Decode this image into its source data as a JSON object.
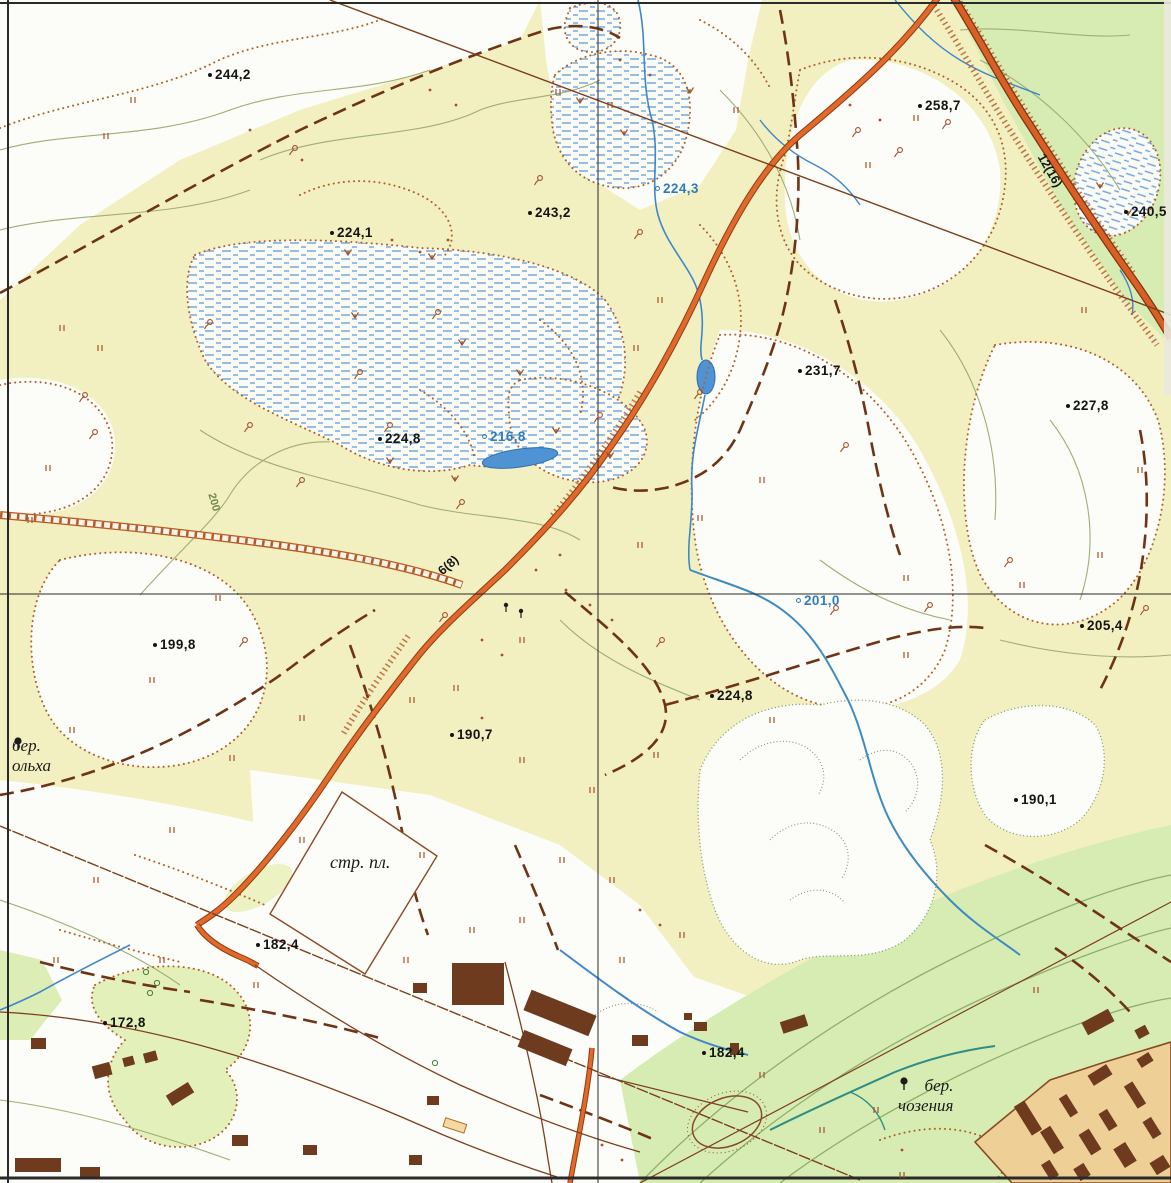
{
  "map": {
    "spot_elevations": [
      {
        "value": "244,2",
        "x": 208,
        "y": 68,
        "color": "black"
      },
      {
        "value": "224,1",
        "x": 330,
        "y": 226,
        "color": "black"
      },
      {
        "value": "243,2",
        "x": 528,
        "y": 206,
        "color": "black"
      },
      {
        "value": "224,3",
        "x": 655,
        "y": 182,
        "color": "blue"
      },
      {
        "value": "258,7",
        "x": 918,
        "y": 99,
        "color": "black"
      },
      {
        "value": "240,5",
        "x": 1124,
        "y": 205,
        "color": "black"
      },
      {
        "value": "231,7",
        "x": 798,
        "y": 364,
        "color": "black"
      },
      {
        "value": "227,8",
        "x": 1066,
        "y": 399,
        "color": "black"
      },
      {
        "value": "224,8",
        "x": 378,
        "y": 432,
        "color": "black"
      },
      {
        "value": "216,8",
        "x": 482,
        "y": 430,
        "color": "blue"
      },
      {
        "value": "201,0",
        "x": 796,
        "y": 594,
        "color": "blue"
      },
      {
        "value": "205,4",
        "x": 1080,
        "y": 619,
        "color": "black"
      },
      {
        "value": "199,8",
        "x": 153,
        "y": 638,
        "color": "black"
      },
      {
        "value": "224,8",
        "x": 710,
        "y": 689,
        "color": "black"
      },
      {
        "value": "190,7",
        "x": 450,
        "y": 728,
        "color": "black"
      },
      {
        "value": "190,1",
        "x": 1014,
        "y": 793,
        "color": "black"
      },
      {
        "value": "172,8",
        "x": 103,
        "y": 1016,
        "color": "black"
      },
      {
        "value": "182,4",
        "x": 256,
        "y": 938,
        "color": "black"
      },
      {
        "value": "182,4",
        "x": 702,
        "y": 1046,
        "color": "black"
      }
    ],
    "place_labels": {
      "construction_site": "стр. пл.",
      "alder_1": "бер.",
      "alder_2": "ольха",
      "chosenia_1": "бер.",
      "chosenia_2": "чозения",
      "contour": "200",
      "road_main": "6(8)",
      "road_ne": "12(16)"
    },
    "legend_colors": {
      "clearing_yellow": "#f2efc0",
      "open_white": "#fcfcf8",
      "meadow_green": "#d7ecb2",
      "urban_tan": "#eecf96",
      "building_brown": "#6e3b1f",
      "road_orange": "#e2692c",
      "water_blue": "#3f87c9",
      "marsh_blue": "#6fa3d8",
      "track_brown": "#6f3316",
      "contour_olive": "#9fae76"
    },
    "decorations": {
      "grass": [
        [
          133,
          100
        ],
        [
          106,
          136
        ],
        [
          62,
          328
        ],
        [
          48,
          468
        ],
        [
          100,
          348
        ],
        [
          30,
          520
        ],
        [
          218,
          598
        ],
        [
          152,
          680
        ],
        [
          72,
          730
        ],
        [
          232,
          758
        ],
        [
          302,
          718
        ],
        [
          412,
          700
        ],
        [
          456,
          688
        ],
        [
          522,
          640
        ],
        [
          640,
          545
        ],
        [
          700,
          518
        ],
        [
          762,
          480
        ],
        [
          906,
          578
        ],
        [
          916,
          118
        ],
        [
          868,
          165
        ],
        [
          1084,
          310
        ],
        [
          1140,
          470
        ],
        [
          1100,
          555
        ],
        [
          1022,
          585
        ],
        [
          906,
          655
        ],
        [
          772,
          720
        ],
        [
          656,
          755
        ],
        [
          592,
          790
        ],
        [
          522,
          760
        ],
        [
          562,
          860
        ],
        [
          612,
          880
        ],
        [
          522,
          920
        ],
        [
          422,
          855
        ],
        [
          302,
          840
        ],
        [
          172,
          830
        ],
        [
          96,
          880
        ],
        [
          56,
          960
        ],
        [
          162,
          960
        ],
        [
          256,
          985
        ],
        [
          406,
          960
        ],
        [
          472,
          930
        ],
        [
          622,
          960
        ],
        [
          682,
          935
        ],
        [
          762,
          1075
        ],
        [
          822,
          1130
        ],
        [
          902,
          1175
        ],
        [
          1036,
          990
        ],
        [
          610,
          105
        ],
        [
          558,
          92
        ],
        [
          736,
          110
        ],
        [
          660,
          300
        ],
        [
          636,
          348
        ],
        [
          876,
          1110
        ]
      ],
      "bush": [
        [
          295,
          148
        ],
        [
          438,
          312
        ],
        [
          390,
          425
        ],
        [
          250,
          425
        ],
        [
          95,
          432
        ],
        [
          85,
          395
        ],
        [
          245,
          640
        ],
        [
          445,
          615
        ],
        [
          930,
          605
        ],
        [
          948,
          122
        ],
        [
          900,
          150
        ],
        [
          858,
          130
        ],
        [
          1010,
          560
        ],
        [
          846,
          445
        ],
        [
          540,
          178
        ],
        [
          640,
          232
        ],
        [
          700,
          392
        ],
        [
          302,
          480
        ],
        [
          210,
          322
        ],
        [
          360,
          372
        ],
        [
          462,
          502
        ],
        [
          662,
          640
        ],
        [
          600,
          415
        ],
        [
          1146,
          608
        ],
        [
          836,
          608
        ]
      ],
      "marsh": [
        [
          355,
          315
        ],
        [
          462,
          342
        ],
        [
          520,
          372
        ],
        [
          580,
          100
        ],
        [
          624,
          132
        ],
        [
          390,
          460
        ],
        [
          455,
          478
        ],
        [
          690,
          90
        ],
        [
          1100,
          185
        ],
        [
          1128,
          212
        ],
        [
          432,
          256
        ],
        [
          556,
          430
        ],
        [
          610,
          455
        ],
        [
          348,
          252
        ]
      ],
      "dot": [
        [
          250,
          130
        ],
        [
          270,
          145
        ],
        [
          302,
          160
        ],
        [
          430,
          90
        ],
        [
          456,
          105
        ],
        [
          620,
          60
        ],
        [
          650,
          75
        ],
        [
          566,
          590
        ],
        [
          590,
          605
        ],
        [
          612,
          620
        ],
        [
          482,
          640
        ],
        [
          502,
          655
        ],
        [
          880,
          120
        ],
        [
          850,
          105
        ],
        [
          640,
          910
        ],
        [
          660,
          925
        ],
        [
          602,
          1145
        ],
        [
          622,
          1160
        ],
        [
          902,
          1150
        ],
        [
          482,
          718
        ],
        [
          392,
          240
        ],
        [
          420,
          252
        ],
        [
          448,
          240
        ],
        [
          560,
          555
        ],
        [
          536,
          570
        ]
      ],
      "tree": [
        [
          146,
          972
        ],
        [
          157,
          983
        ],
        [
          150,
          993
        ],
        [
          435,
          1063
        ]
      ],
      "treeb": [
        [
          506,
          608
        ],
        [
          521,
          614
        ]
      ]
    }
  }
}
